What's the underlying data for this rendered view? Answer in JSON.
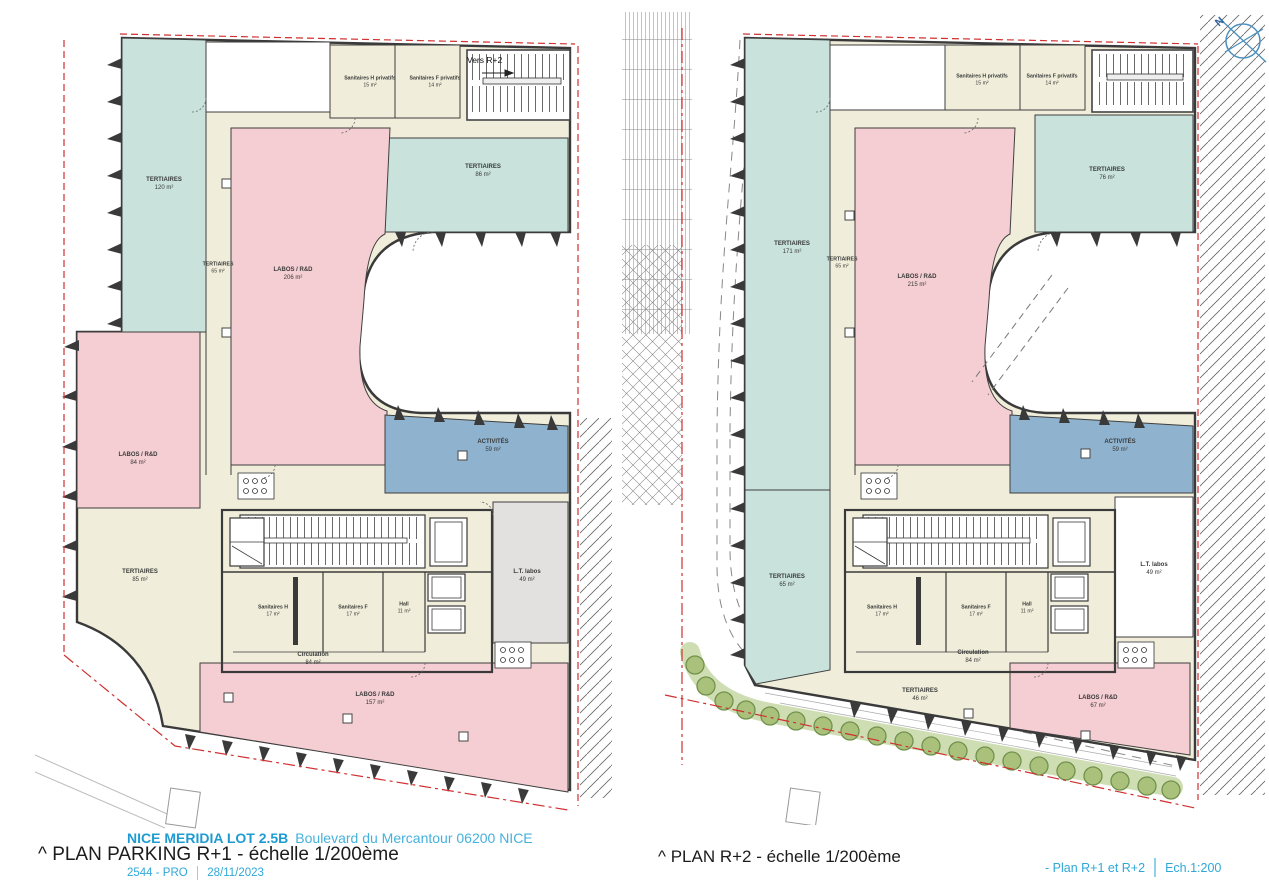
{
  "footer": {
    "project_name": "NICE MERIDIA LOT 2.5B",
    "project_address": "Boulevard du Mercantour 06200 NICE",
    "left_plan_title": "^ PLAN PARKING R+1 - échelle 1/200ème",
    "right_plan_title": "^ PLAN R+2 - échelle 1/200ème",
    "doc_ref": "2544 - PRO",
    "doc_date": "28/11/2023",
    "sheet_label": "- Plan R+1 et R+2",
    "scale_label": "Ech.1:200"
  },
  "compass": {
    "label": "N"
  },
  "colors": {
    "tertiaires_teal": "#c9e3dc",
    "labos_pink": "#f4ced3",
    "circulation_cream": "#f0eeda",
    "activites_blue": "#8fb3ce",
    "lt_labos_gray": "#e2e1df",
    "boundary_red": "#cf3030",
    "accent_blue": "#2fa8d8",
    "planting_green": "#a9c17b"
  },
  "plans": {
    "left": {
      "name": "PLAN PARKING R+1",
      "stair_note": "Vers R+2",
      "rooms": [
        {
          "id": "tertiaires-120",
          "label": "TERTIAIRES",
          "area": "120 m²"
        },
        {
          "id": "sanitaires-h-privatifs",
          "label": "Sanitaires H privatifs",
          "area": "15 m²"
        },
        {
          "id": "sanitaires-f-privatifs",
          "label": "Sanitaires F privatifs",
          "area": "14 m²"
        },
        {
          "id": "tertiaires-86",
          "label": "TERTIAIRES",
          "area": "86 m²"
        },
        {
          "id": "tertiaires-65",
          "label": "TERTIAIRES",
          "area": "65 m²"
        },
        {
          "id": "labos-rd-206",
          "label": "LABOS / R&D",
          "area": "206 m²"
        },
        {
          "id": "labos-rd-84",
          "label": "LABOS / R&D",
          "area": "84 m²"
        },
        {
          "id": "tertiaires-85",
          "label": "TERTIAIRES",
          "area": "85 m²"
        },
        {
          "id": "activites-59",
          "label": "ACTIVITÉS",
          "area": "59 m²"
        },
        {
          "id": "lt-labos-49",
          "label": "L.T. labos",
          "area": "49 m²"
        },
        {
          "id": "sanitaires-h",
          "label": "Sanitaires H",
          "area": "17 m²"
        },
        {
          "id": "sanitaires-f",
          "label": "Sanitaires F",
          "area": "17 m²"
        },
        {
          "id": "hall",
          "label": "Hall",
          "area": "11 m²"
        },
        {
          "id": "circulation",
          "label": "Circulation",
          "area": "84 m²"
        },
        {
          "id": "labos-rd-157",
          "label": "LABOS / R&D",
          "area": "157 m²"
        }
      ]
    },
    "right": {
      "name": "PLAN R+2",
      "rooms": [
        {
          "id": "tertiaires-171",
          "label": "TERTIAIRES",
          "area": "171 m²"
        },
        {
          "id": "sanitaires-h-privatifs",
          "label": "Sanitaires H privatifs",
          "area": "15 m²"
        },
        {
          "id": "sanitaires-f-privatifs",
          "label": "Sanitaires F privatifs",
          "area": "14 m²"
        },
        {
          "id": "tertiaires-76",
          "label": "TERTIAIRES",
          "area": "76 m²"
        },
        {
          "id": "tertiaires-65-strip",
          "label": "TERTIAIRES",
          "area": "65 m²"
        },
        {
          "id": "labos-rd-215",
          "label": "LABOS / R&D",
          "area": "215 m²"
        },
        {
          "id": "tertiaires-65-bas",
          "label": "TERTIAIRES",
          "area": "65 m²"
        },
        {
          "id": "activites-59",
          "label": "ACTIVITÉS",
          "area": "59 m²"
        },
        {
          "id": "lt-labos-49",
          "label": "L.T. labos",
          "area": "49 m²"
        },
        {
          "id": "sanitaires-h",
          "label": "Sanitaires H",
          "area": "17 m²"
        },
        {
          "id": "sanitaires-f",
          "label": "Sanitaires F",
          "area": "17 m²"
        },
        {
          "id": "hall",
          "label": "Hall",
          "area": "11 m²"
        },
        {
          "id": "circulation",
          "label": "Circulation",
          "area": "84 m²"
        },
        {
          "id": "tertiaires-46",
          "label": "TERTIAIRES",
          "area": "46 m²"
        },
        {
          "id": "labos-rd-67",
          "label": "LABOS / R&D",
          "area": "67 m²"
        }
      ]
    }
  }
}
